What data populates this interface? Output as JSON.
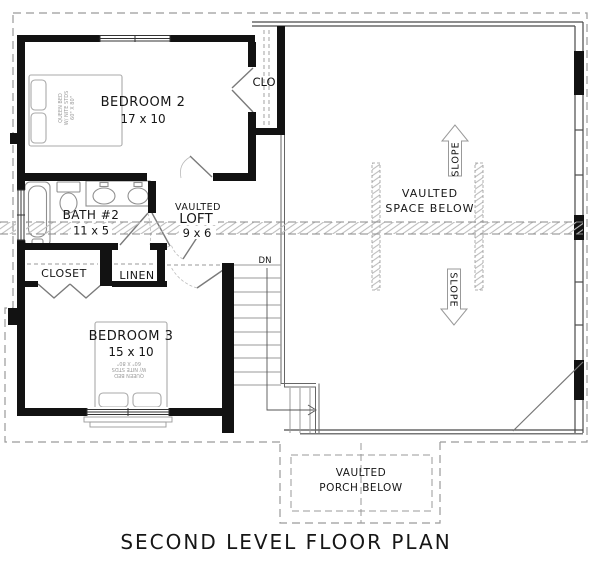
{
  "title": "SECOND LEVEL FLOOR PLAN",
  "rooms": {
    "bedroom2": {
      "name": "BEDROOM 2",
      "dims": "17 x 10"
    },
    "bedroom3": {
      "name": "BEDROOM 3",
      "dims": "15 x 10"
    },
    "bath2": {
      "name": "BATH #2",
      "dims": "11 x 5"
    },
    "loft": {
      "prefix": "VAULTED",
      "name": "LOFT",
      "dims": "9 x 6"
    },
    "clo": {
      "name": "CLO"
    },
    "closet": {
      "name": "CLOSET"
    },
    "linen": {
      "name": "LINEN"
    }
  },
  "annotations": {
    "vaulted_space": {
      "line1": "VAULTED",
      "line2": "SPACE BELOW"
    },
    "vaulted_porch": {
      "line1": "VAULTED",
      "line2": "PORCH BELOW"
    },
    "slope_up": "SLOPE",
    "slope_down": "SLOPE",
    "stairs_down": "DN",
    "bed2_note": {
      "line1": "QUEEN BED",
      "line2": "W/ NITE STDS",
      "line3": "60\" X 80\""
    },
    "bed3_note": {
      "line1": "QUEEN BED",
      "line2": "W/ NITE STDS",
      "line3": "60\" X 80\""
    }
  },
  "colors": {
    "wall": "#121212",
    "thin_wall": "#4a4a4a",
    "fixture": "#9a9a9a",
    "door": "#7a7a7a",
    "roof_dash": "#9a9a9a",
    "hatch": "#bdbdbd",
    "text": "#161616"
  }
}
